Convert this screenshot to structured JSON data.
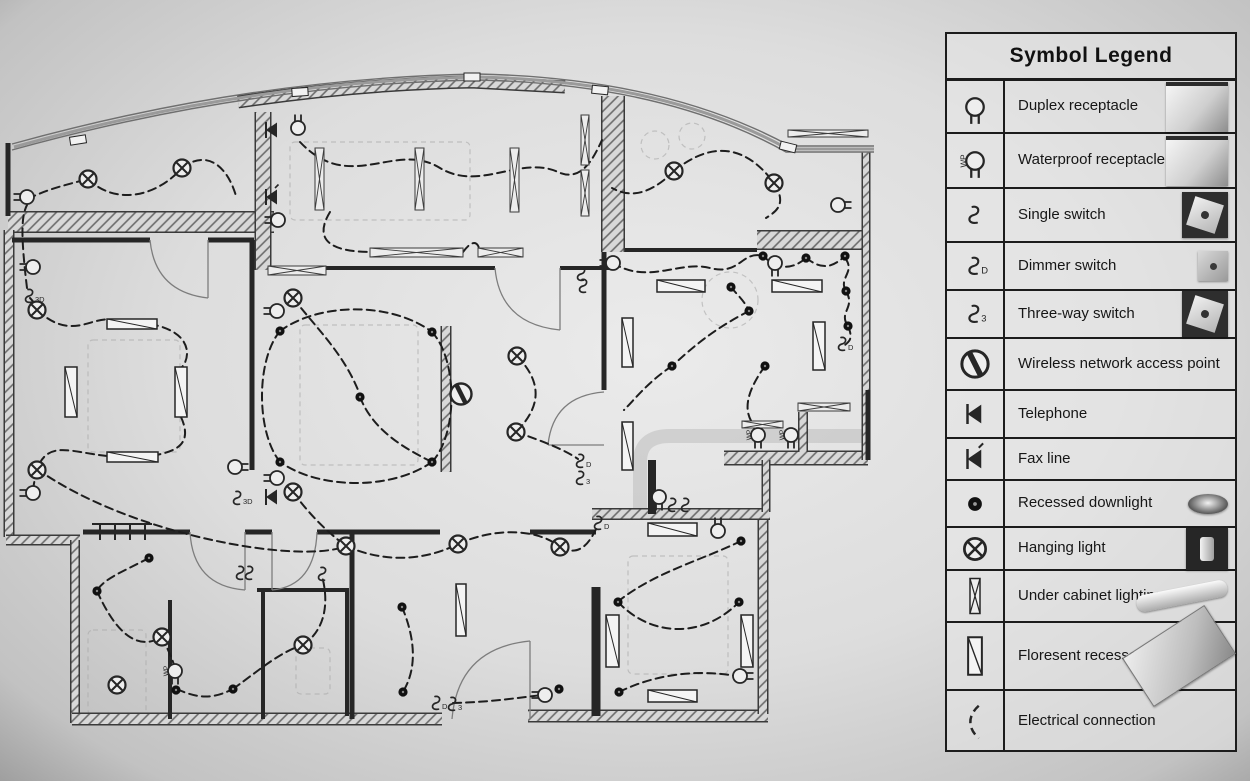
{
  "legend": {
    "title": "Symbol Legend",
    "rows": [
      {
        "id": "duplex-receptacle",
        "label": "Duplex receptacle",
        "photo": "receptacle"
      },
      {
        "id": "waterproof-receptacle",
        "label": "Waterproof receptacle",
        "photo": "receptacle"
      },
      {
        "id": "single-switch",
        "label": "Single switch",
        "photo": "switch"
      },
      {
        "id": "dimmer-switch",
        "label": "Dimmer switch",
        "photo": "switch-sm"
      },
      {
        "id": "three-way-switch",
        "label": "Three-way switch",
        "photo": "switch"
      },
      {
        "id": "wireless-ap",
        "label": "Wireless network access point",
        "photo": ""
      },
      {
        "id": "telephone",
        "label": "Telephone",
        "photo": ""
      },
      {
        "id": "fax-line",
        "label": "Fax line",
        "photo": ""
      },
      {
        "id": "recessed-downlight",
        "label": "Recessed downlight",
        "photo": "downlight"
      },
      {
        "id": "hanging-light",
        "label": "Hanging light",
        "photo": "hanging"
      },
      {
        "id": "under-cabinet",
        "label": "Under cabinet lighting",
        "photo": "tube"
      },
      {
        "id": "fluorescent",
        "label": "Floresent recessed light",
        "photo": "tube-big"
      },
      {
        "id": "electrical-connection",
        "label": "Electrical connection",
        "photo": ""
      }
    ],
    "row_heights": [
      53,
      55,
      54,
      48,
      48,
      52,
      48,
      42,
      47,
      43,
      52,
      68,
      61
    ]
  },
  "plan": {
    "ink": "#262626",
    "walls_hatched": [
      [
        "M 8,222 L 274,222",
        22
      ],
      [
        "M 263,112 L 263,270",
        17
      ],
      [
        "M 238,102 Q 360,84 472,82 L 565,87",
        13
      ],
      [
        "M 613,96 L 613,252",
        24
      ],
      [
        "M 757,240 L 864,240",
        20
      ],
      [
        "M 9,230 L 9,537",
        11
      ],
      [
        "M 6,540 L 80,540",
        11
      ],
      [
        "M 75,540 L 75,723",
        10
      ],
      [
        "M 72,719 L 442,719",
        13
      ],
      [
        "M 528,716 L 768,716",
        13
      ],
      [
        "M 763,520 L 763,714",
        11
      ],
      [
        "M 592,514 L 770,514",
        12
      ],
      [
        "M 724,458 L 868,458",
        15
      ],
      [
        "M 866,152 L 866,460",
        9
      ],
      [
        "M 803,412 L 803,452",
        10
      ],
      [
        "M 766,460 L 766,512",
        9
      ],
      [
        "M 446,326 L 446,472",
        11
      ]
    ],
    "walls_plain": [
      [
        "M 12,240 L 150,240",
        5
      ],
      [
        "M 208,240 L 254,240",
        5
      ],
      [
        "M 252,240 L 252,470",
        5
      ],
      [
        "M 272,268 L 495,268",
        4
      ],
      [
        "M 560,268 L 612,268",
        4
      ],
      [
        "M 625,250 L 757,250",
        4
      ],
      [
        "M 604,252 L 604,390",
        5
      ],
      [
        "M 8,143 L 8,216",
        5
      ],
      [
        "M 83,532 L 190,532",
        5
      ],
      [
        "M 245,532 L 272,532",
        5
      ],
      [
        "M 317,532 L 440,532",
        5
      ],
      [
        "M 352,532 L 352,719",
        5
      ],
      [
        "M 530,532 L 596,532",
        5
      ],
      [
        "M 170,600 L 170,719",
        4
      ],
      [
        "M 257,590 L 347,590 L 347,716",
        4
      ],
      [
        "M 263,590 L 263,719",
        4
      ],
      [
        "M 596,587 L 596,716",
        9
      ],
      [
        "M 652,460 L 652,514",
        8
      ],
      [
        "M 868,390 L 868,460",
        5
      ]
    ],
    "glass": [
      "M 12,150 Q 250,84 478,80 Q 665,84 786,152 L 874,152",
      "M 14,147 Q 250,81 478,77 Q 665,81 788,149 L 874,149",
      "M 12,144 Q 250,78 478,74 Q 665,78 790,146 L 874,146"
    ],
    "sills": [
      [
        78,
        140,
        -9
      ],
      [
        300,
        92,
        -4
      ],
      [
        472,
        77,
        0
      ],
      [
        600,
        90,
        6
      ],
      [
        788,
        147,
        14
      ]
    ],
    "doors": [
      "M 208,240 L 208,298",
      "M 208,298 Q 155,292 150,240",
      "M 560,268 L 560,330",
      "M 560,330 Q 500,324 495,268",
      "M 245,532 L 245,590",
      "M 245,590 Q 193,586 190,532",
      "M 272,532 L 272,590",
      "M 272,590 Q 315,586 317,532",
      "M 530,719 L 530,641",
      "M 530,641 Q 458,648 452,719",
      "M 604,445 L 548,445",
      "M 548,445 Q 553,396 604,392"
    ],
    "closet_ticks": [
      "M 100,524 L 100,540",
      "M 115,524 L 115,540",
      "M 130,524 L 130,540",
      "M 145,524 L 145,540",
      "M 92,524 L 152,524"
    ],
    "furniture_rects": [
      [
        88,
        340,
        92,
        112
      ],
      [
        300,
        325,
        118,
        140
      ],
      [
        290,
        142,
        180,
        78
      ],
      [
        628,
        556,
        100,
        118
      ],
      [
        88,
        630,
        58,
        85
      ],
      [
        296,
        648,
        34,
        46
      ]
    ],
    "furniture_circles": [
      [
        730,
        300,
        28
      ],
      [
        655,
        145,
        14
      ],
      [
        692,
        136,
        13
      ]
    ],
    "furniture_paths": [
      "M 640,512 L 640,462 Q 640,436 670,436 L 866,436"
    ],
    "connections": [
      "M 88,179 C 115,205 155,198 182,168",
      "M 182,168 C 208,148 228,168 236,196",
      "M 28,199 C 45,190 65,185 88,179",
      "M 30,298 C 34,302 36,306 37,310",
      "M 37,310 C 75,345 95,310 118,322",
      "M 150,324 C 195,332 190,360 181,368",
      "M 181,417 C 195,448 170,452 152,456",
      "M 107,456 C 70,452 48,440 37,469",
      "M 37,469 C 130,535 300,565 346,546",
      "M 27,288 C 20,230 22,215 27,205",
      "M 300,142 C 350,195 395,140 440,168 C 480,192 520,155 558,172 C 580,182 592,162 602,140",
      "M 330,212 C 310,245 340,252 372,252",
      "M 463,252 C 472,240 478,240 480,252",
      "M 674,171 C 645,200 625,195 612,188",
      "M 674,171 C 715,138 748,148 774,183 C 788,205 775,212 766,218",
      "M 613,263 C 648,285 680,260 710,268 C 740,276 742,250 763,256",
      "M 763,256 C 778,270 792,270 806,258",
      "M 806,258 C 822,270 832,268 845,256",
      "M 845,258 C 856,272 838,278 846,291",
      "M 846,291 C 856,308 838,312 848,326",
      "M 848,326 C 854,340 848,342 845,345",
      "M 731,287 C 738,296 744,300 749,311",
      "M 749,311 C 712,330 692,348 672,366",
      "M 672,366 C 648,382 636,398 624,410",
      "M 280,331 C 320,302 392,302 432,332",
      "M 432,332 C 458,360 458,434 432,462",
      "M 432,462 C 392,490 320,490 280,462",
      "M 280,462 C 256,432 256,360 280,331",
      "M 360,397 C 372,428 400,446 428,460",
      "M 293,298 C 318,330 345,355 360,395",
      "M 517,356 C 542,382 542,406 516,432",
      "M 516,432 C 545,442 565,450 578,459",
      "M 293,492 C 312,518 330,534 346,546",
      "M 346,546 C 382,562 422,562 458,544",
      "M 458,544 C 498,526 540,530 560,547",
      "M 560,547 C 580,558 590,542 597,527",
      "M 741,541 C 702,560 656,572 620,600",
      "M 618,602 C 652,638 704,638 739,602",
      "M 619,692 C 660,672 702,670 736,676",
      "M 453,703 C 495,702 522,697 543,695",
      "M 149,558 C 122,572 106,578 98,589",
      "M 97,591 C 118,638 140,650 162,637",
      "M 162,637 C 169,652 172,658 175,668",
      "M 177,689 C 200,700 215,698 233,689",
      "M 233,689 C 262,668 280,652 303,645",
      "M 303,645 C 328,628 328,598 322,576",
      "M 402,607 C 420,650 412,676 404,690",
      "M 765,366 C 742,398 744,416 758,430",
      "M 33,490 C 34,483 35,477 37,472"
    ],
    "hanging_lights": [
      [
        88,
        179
      ],
      [
        182,
        168
      ],
      [
        37,
        310
      ],
      [
        37,
        470
      ],
      [
        293,
        298
      ],
      [
        517,
        356
      ],
      [
        516,
        432
      ],
      [
        293,
        492
      ],
      [
        674,
        171
      ],
      [
        774,
        183
      ],
      [
        346,
        546
      ],
      [
        458,
        544
      ],
      [
        560,
        547
      ],
      [
        162,
        637
      ],
      [
        117,
        685
      ],
      [
        303,
        645
      ]
    ],
    "downlights": [
      [
        763,
        256
      ],
      [
        806,
        258
      ],
      [
        845,
        256
      ],
      [
        731,
        287
      ],
      [
        749,
        311
      ],
      [
        846,
        291
      ],
      [
        848,
        326
      ],
      [
        765,
        366
      ],
      [
        672,
        366
      ],
      [
        280,
        331
      ],
      [
        432,
        332
      ],
      [
        360,
        397
      ],
      [
        280,
        462
      ],
      [
        432,
        462
      ],
      [
        741,
        541
      ],
      [
        618,
        602
      ],
      [
        739,
        602
      ],
      [
        619,
        692
      ],
      [
        149,
        558
      ],
      [
        97,
        591
      ],
      [
        176,
        690
      ],
      [
        233,
        689
      ],
      [
        402,
        607
      ],
      [
        403,
        692
      ],
      [
        559,
        689
      ]
    ],
    "receptacles": [
      [
        27,
        197,
        90
      ],
      [
        33,
        267,
        90
      ],
      [
        33,
        493,
        90
      ],
      [
        235,
        467,
        -90
      ],
      [
        277,
        311,
        90
      ],
      [
        277,
        478,
        90
      ],
      [
        298,
        128,
        180
      ],
      [
        278,
        220,
        90
      ],
      [
        838,
        205,
        -90
      ],
      [
        613,
        263,
        90
      ],
      [
        775,
        263,
        0
      ],
      [
        659,
        497,
        0
      ],
      [
        545,
        695,
        90
      ],
      [
        740,
        676,
        -90
      ],
      [
        718,
        531,
        180
      ]
    ],
    "wp_receptacles": [
      [
        758,
        435,
        0
      ],
      [
        791,
        435,
        0
      ],
      [
        175,
        671,
        0
      ]
    ],
    "wp_label": "WP",
    "switches": [
      [
        30,
        296,
        "3D"
      ],
      [
        238,
        498,
        "3D"
      ],
      [
        241,
        573,
        ""
      ],
      [
        250,
        573,
        ""
      ],
      [
        323,
        574,
        ""
      ],
      [
        437,
        703,
        "D"
      ],
      [
        453,
        704,
        "3"
      ],
      [
        581,
        461,
        "D"
      ],
      [
        581,
        478,
        "3"
      ],
      [
        599,
        523,
        "D"
      ],
      [
        843,
        344,
        "D"
      ],
      [
        673,
        505,
        ""
      ],
      [
        686,
        505,
        ""
      ],
      [
        582,
        274,
        ""
      ],
      [
        584,
        286,
        ""
      ]
    ],
    "telephones": [
      [
        272,
        130
      ],
      [
        272,
        497
      ]
    ],
    "fax_lines": [
      [
        272,
        197
      ]
    ],
    "wireless_aps": [
      [
        461,
        394
      ]
    ],
    "fluorescents": [
      [
        107,
        319,
        50,
        10
      ],
      [
        107,
        452,
        51,
        10
      ],
      [
        65,
        367,
        12,
        50
      ],
      [
        175,
        367,
        12,
        50
      ],
      [
        657,
        280,
        48,
        12
      ],
      [
        772,
        280,
        50,
        12
      ],
      [
        813,
        322,
        12,
        48
      ],
      [
        622,
        318,
        11,
        49
      ],
      [
        622,
        422,
        11,
        48
      ],
      [
        648,
        523,
        49,
        13
      ],
      [
        606,
        615,
        13,
        52
      ],
      [
        741,
        615,
        12,
        52
      ],
      [
        648,
        690,
        49,
        12
      ],
      [
        456,
        584,
        10,
        52
      ]
    ],
    "under_cabinet": [
      [
        315,
        148,
        9,
        62
      ],
      [
        415,
        148,
        9,
        62
      ],
      [
        510,
        148,
        9,
        64
      ],
      [
        581,
        115,
        8,
        50
      ],
      [
        581,
        170,
        8,
        46
      ],
      [
        370,
        248,
        93,
        9
      ],
      [
        478,
        248,
        45,
        9
      ],
      [
        268,
        266,
        58,
        9
      ],
      [
        798,
        403,
        52,
        8
      ],
      [
        742,
        421,
        41,
        7
      ],
      [
        788,
        130,
        80,
        7
      ]
    ]
  }
}
